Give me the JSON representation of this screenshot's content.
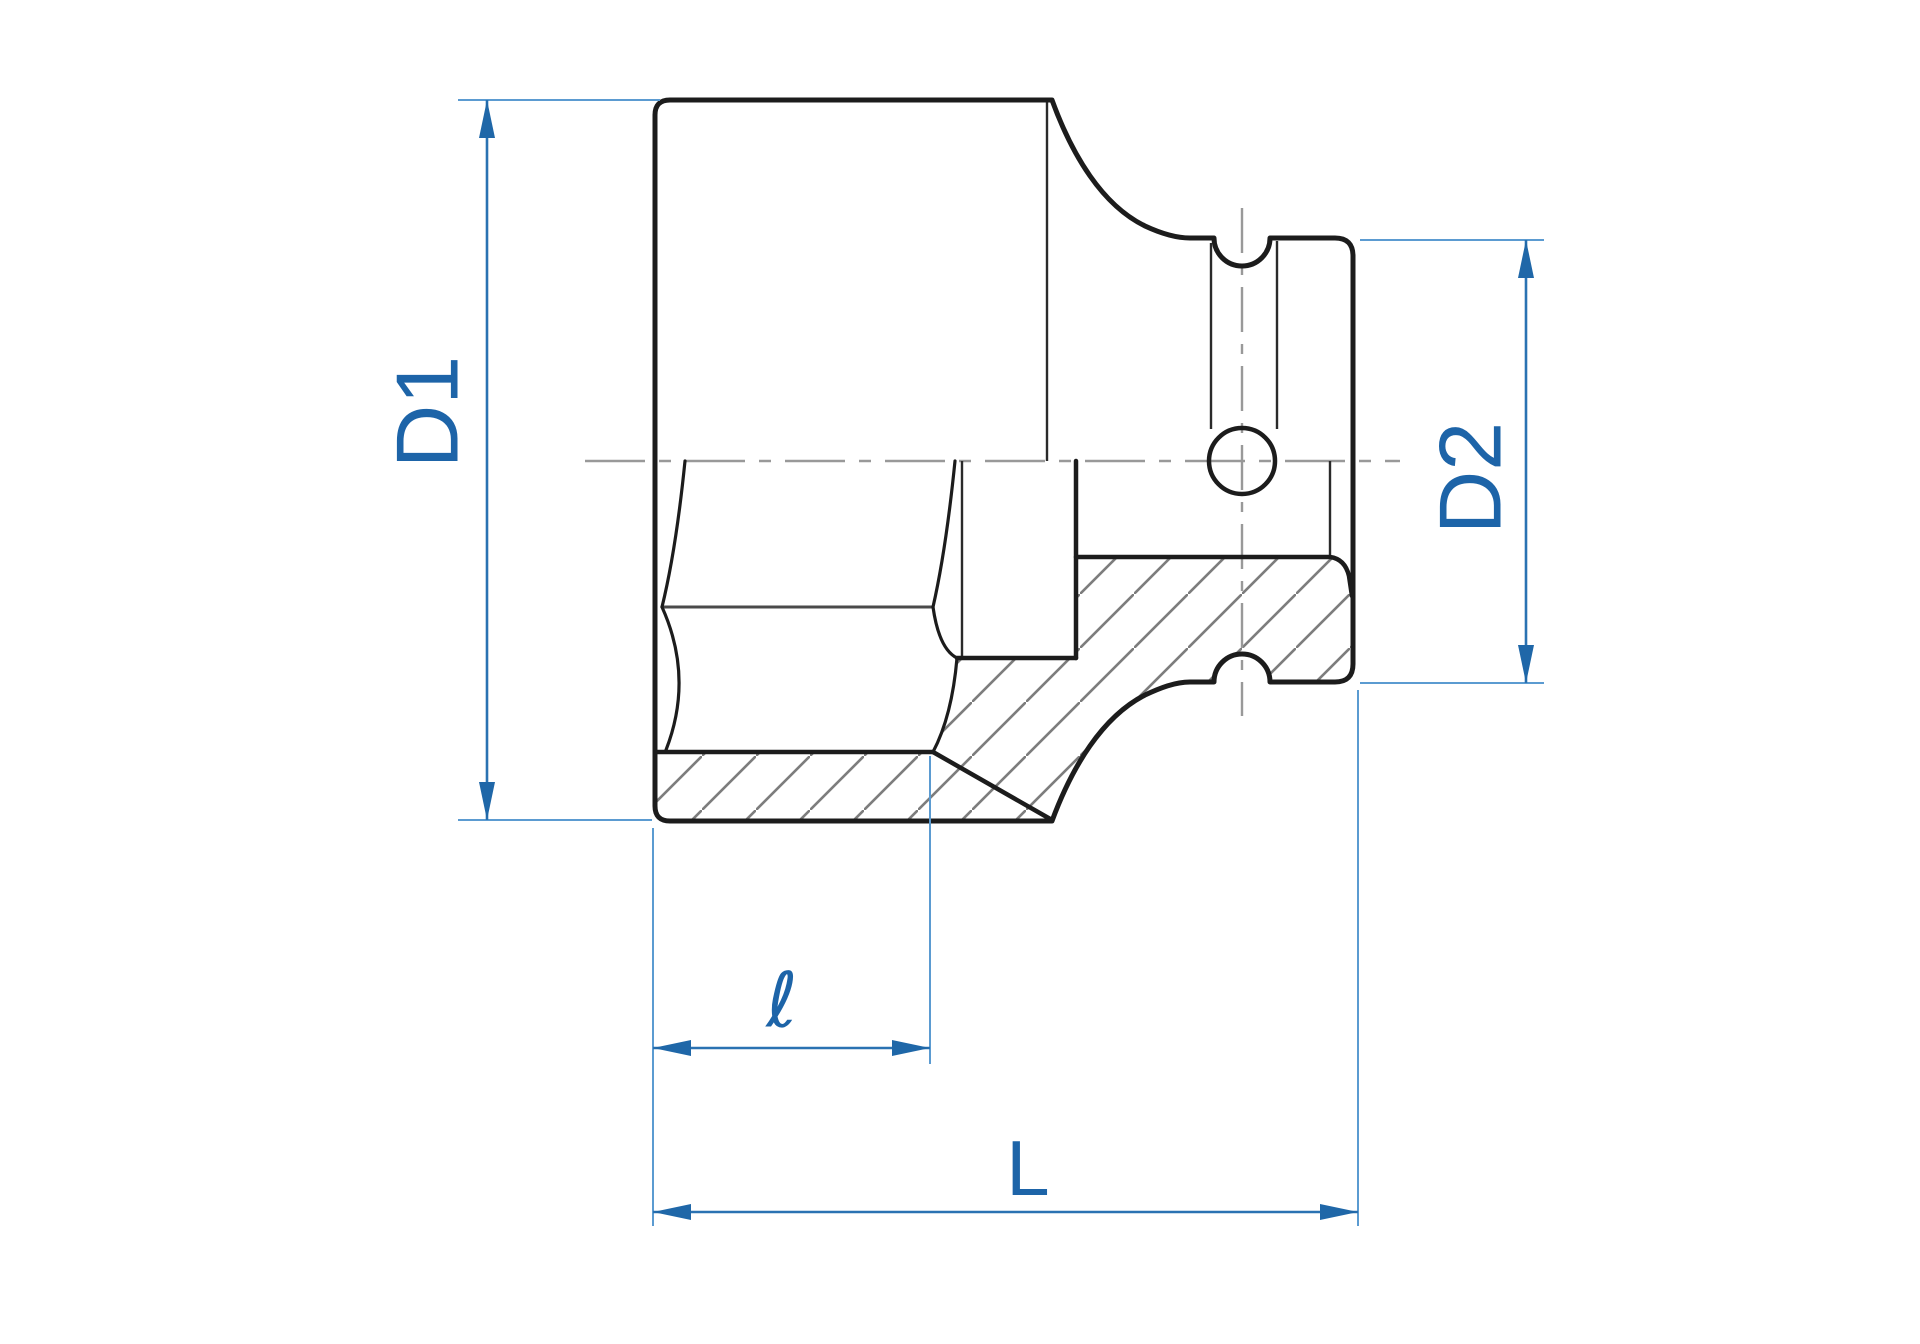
{
  "diagram": {
    "kind": "technical-drawing",
    "dimensions": {
      "d1": {
        "label": "D1"
      },
      "d2": {
        "label": "D2"
      },
      "hex_depth": {
        "label": "ℓ"
      },
      "overall_length": {
        "label": "L"
      }
    },
    "colors": {
      "dimension_blue": "#2a72b2",
      "extension_blue": "#5b9bd1",
      "arrow_blue": "#1f67a8",
      "label_blue": "#1d64a8",
      "drawing_black": "#1c1c1c",
      "centerline_gray": "#999999",
      "hatch_gray": "#7d7d7d",
      "background": "#ffffff"
    }
  }
}
